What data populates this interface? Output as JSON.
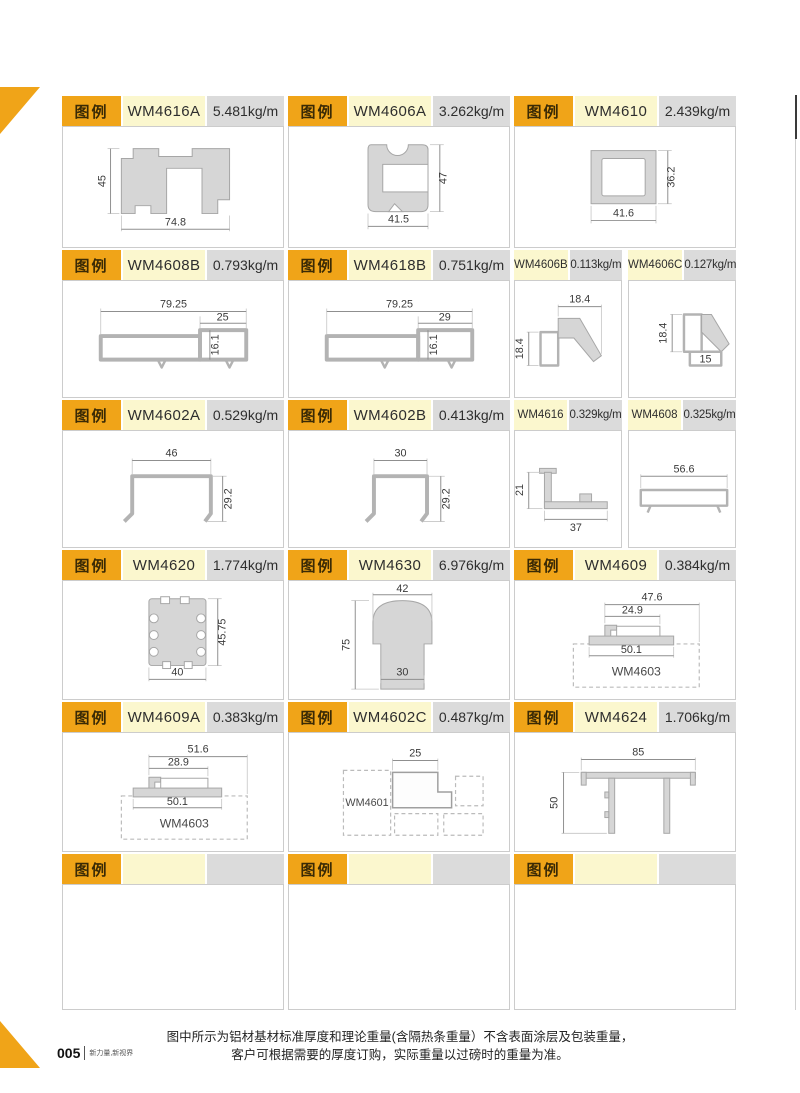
{
  "legend_label": "图例",
  "colors": {
    "accent_orange": "#f0a418",
    "model_bg": "#fbf7ce",
    "weight_bg": "#dbdbdb"
  },
  "cells": {
    "wm4616a": {
      "model": "WM4616A",
      "weight": "5.481kg/m",
      "dim_h": "45",
      "dim_w": "74.8"
    },
    "wm4606a": {
      "model": "WM4606A",
      "weight": "3.262kg/m",
      "dim_h": "47",
      "dim_w": "41.5"
    },
    "wm4610": {
      "model": "WM4610",
      "weight": "2.439kg/m",
      "dim_h": "36.2",
      "dim_w": "41.6"
    },
    "wm4608b": {
      "model": "WM4608B",
      "weight": "0.793kg/m",
      "dim_top": "79.25",
      "dim_step": "25",
      "dim_h": "16.1"
    },
    "wm4618b": {
      "model": "WM4618B",
      "weight": "0.751kg/m",
      "dim_top": "79.25",
      "dim_step": "29",
      "dim_h": "16.1"
    },
    "wm4606b": {
      "model": "WM4606B",
      "weight": "0.113kg/m",
      "dim_top": "18.4",
      "dim_left": "18.4"
    },
    "wm4606c": {
      "model": "WM4606C",
      "weight": "0.127kg/m",
      "dim_left": "18.4",
      "dim_bottom": "15"
    },
    "wm4602a": {
      "model": "WM4602A",
      "weight": "0.529kg/m",
      "dim_top": "46",
      "dim_h": "29.2"
    },
    "wm4602b": {
      "model": "WM4602B",
      "weight": "0.413kg/m",
      "dim_top": "30",
      "dim_h": "29.2"
    },
    "wm4616": {
      "model": "WM4616",
      "weight": "0.329kg/m",
      "dim_left": "21",
      "dim_bottom": "37"
    },
    "wm4608": {
      "model": "WM4608",
      "weight": "0.325kg/m",
      "dim_top": "56.6"
    },
    "wm4620": {
      "model": "WM4620",
      "weight": "1.774kg/m",
      "dim_h": "45.75",
      "dim_bottom": "40"
    },
    "wm4630": {
      "model": "WM4630",
      "weight": "6.976kg/m",
      "dim_top": "42",
      "dim_left": "75",
      "dim_bottom": "30"
    },
    "wm4609": {
      "model": "WM4609",
      "weight": "0.384kg/m",
      "dim1": "47.6",
      "dim2": "24.9",
      "dim3": "50.1",
      "ref": "WM4603"
    },
    "wm4609a": {
      "model": "WM4609A",
      "weight": "0.383kg/m",
      "dim1": "51.6",
      "dim2": "28.9",
      "dim3": "50.1",
      "ref": "WM4603"
    },
    "wm4602c": {
      "model": "WM4602C",
      "weight": "0.487kg/m",
      "dim_top": "25",
      "ref": "WM4601"
    },
    "wm4624": {
      "model": "WM4624",
      "weight": "1.706kg/m",
      "dim_top": "85",
      "dim_left": "50"
    }
  },
  "footer": {
    "note1": "图中所示为铝材基材标准厚度和理论重量(含隔热条重量）不含表面涂层及包装重量，",
    "note2": "客户可根据需要的厚度订购，实际重量以过磅时的重量为准。",
    "page_number": "005",
    "tagline": "新力量,新视界"
  }
}
